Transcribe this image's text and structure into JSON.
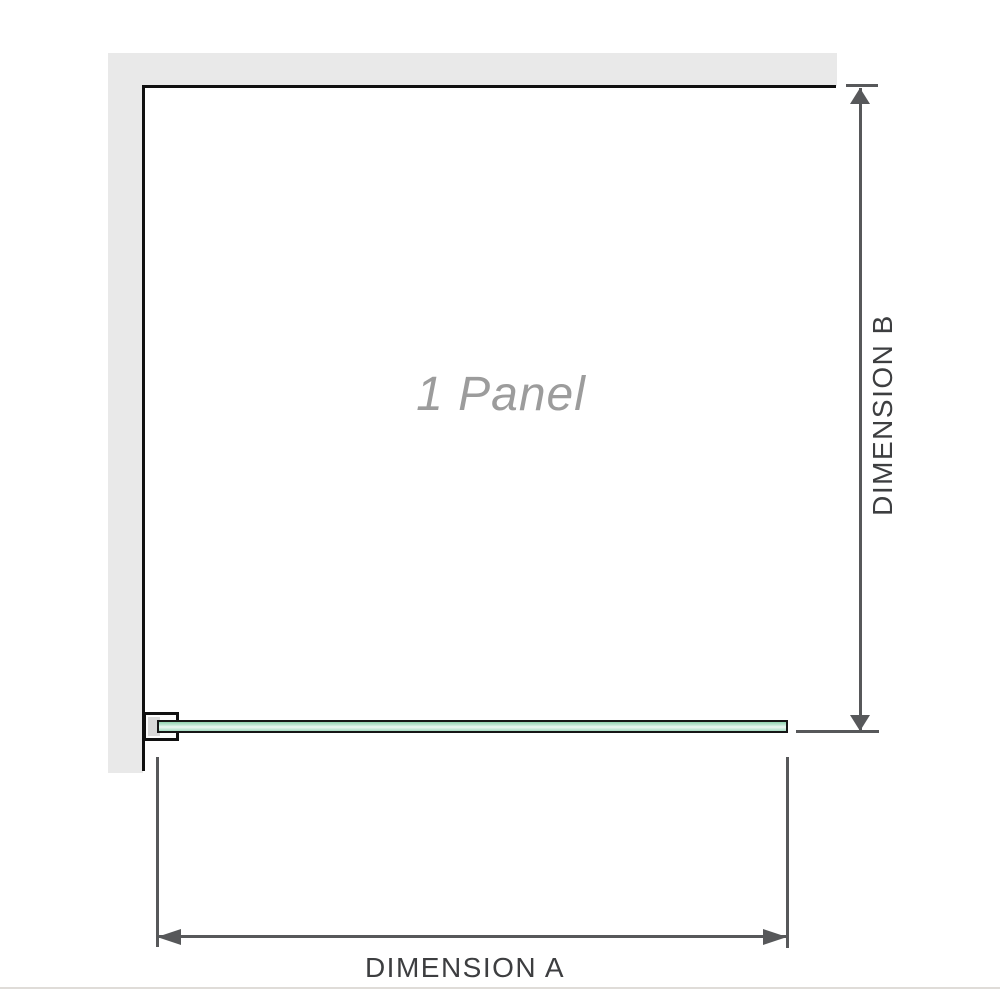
{
  "figure": {
    "panel_label": "1 Panel",
    "dimension_a_label": "DIMENSION A",
    "dimension_b_label": "DIMENSION B"
  },
  "colors": {
    "wall_fill": "#e9e9e9",
    "wall_inner_edge": "#101010",
    "glass_green": "#8fd3ae",
    "glass_green_light": "#eef8f3",
    "glass_border": "#161616",
    "dimension_line": "#57585a",
    "dimension_text": "#3d3e40",
    "watermark_text": "#9c9c9c",
    "bottom_hairline": "#dfdcd8"
  }
}
